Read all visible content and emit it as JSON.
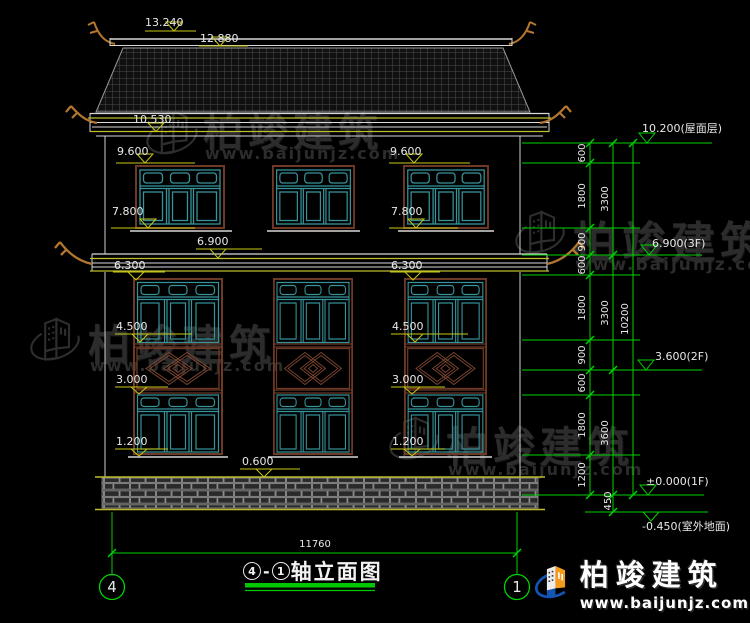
{
  "title_block": {
    "axis_start": "4",
    "axis_end": "1",
    "separator": "-",
    "name": "轴立面图"
  },
  "axis_bubbles": {
    "left": "4",
    "right": "1"
  },
  "watermark": {
    "brand": "柏竣建筑",
    "url": "www.baijunjz.com"
  },
  "logo": {
    "brand": "柏竣建筑",
    "url": "www.baijunjz.com"
  },
  "elevations_left": {
    "ridge": "13.240",
    "roof_top": "12.880",
    "eave": "10.530",
    "win3_top": "9.600",
    "win3_sill": "7.800",
    "floor3": "6.900",
    "win2_top": "6.300",
    "win2_sill": "4.500",
    "win1_top": "3.000",
    "win1_sill": "1.200",
    "plinth": "0.600"
  },
  "elevations_right": {
    "roof": "10.200(屋面层)",
    "f3": "6.900(3F)",
    "f2": "3.600(2F)",
    "f1": "±0.000(1F)",
    "ground": "-0.450(室外地面)"
  },
  "dim_chains": {
    "inner": [
      "600",
      "1800",
      "900",
      "600",
      "1800",
      "900",
      "600",
      "1800",
      "1200"
    ],
    "middle": [
      "3300",
      "3300",
      "3600",
      "450"
    ],
    "overall_height": "10200",
    "overall_width": "11760"
  }
}
